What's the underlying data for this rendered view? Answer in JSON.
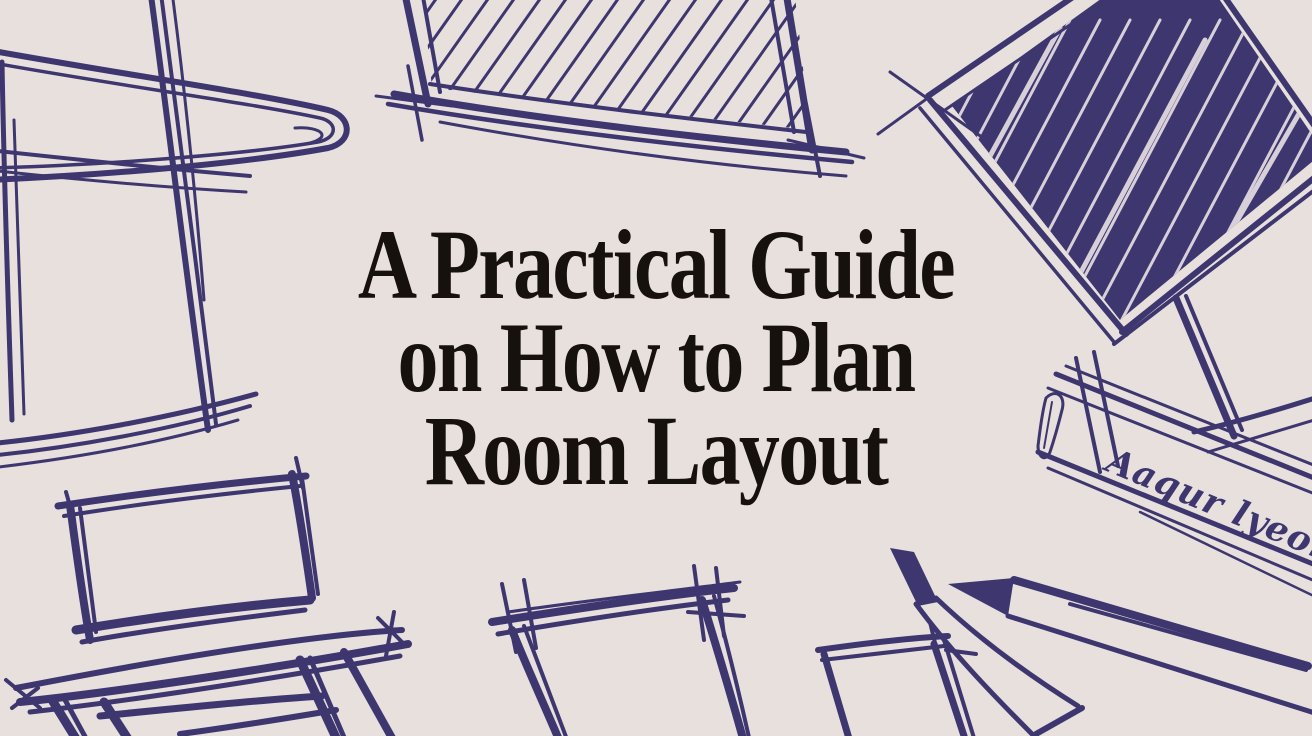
{
  "page": {
    "background_color": "#e7e0dc",
    "ink_color": "#3e366f",
    "title_color": "#17110d",
    "title": {
      "line1": "A Practical Guide",
      "line2": "on How to Plan",
      "line3": "Room Layout",
      "full": "A Practical Guide on How to Plan Room Layout"
    },
    "handwritten_note": "Aaqur lyeored",
    "sketches": [
      {
        "name": "chair-outline-top-left"
      },
      {
        "name": "hatched-picture-frame-top-center"
      },
      {
        "name": "scribble-filled-diamond-canvas-top-right"
      },
      {
        "name": "ruler-banner-with-handwriting-right"
      },
      {
        "name": "chair-bottom-left"
      },
      {
        "name": "picture-frame-bottom-center"
      },
      {
        "name": "picture-frame-bottom-right"
      },
      {
        "name": "two-pencils-bottom-right"
      }
    ]
  }
}
